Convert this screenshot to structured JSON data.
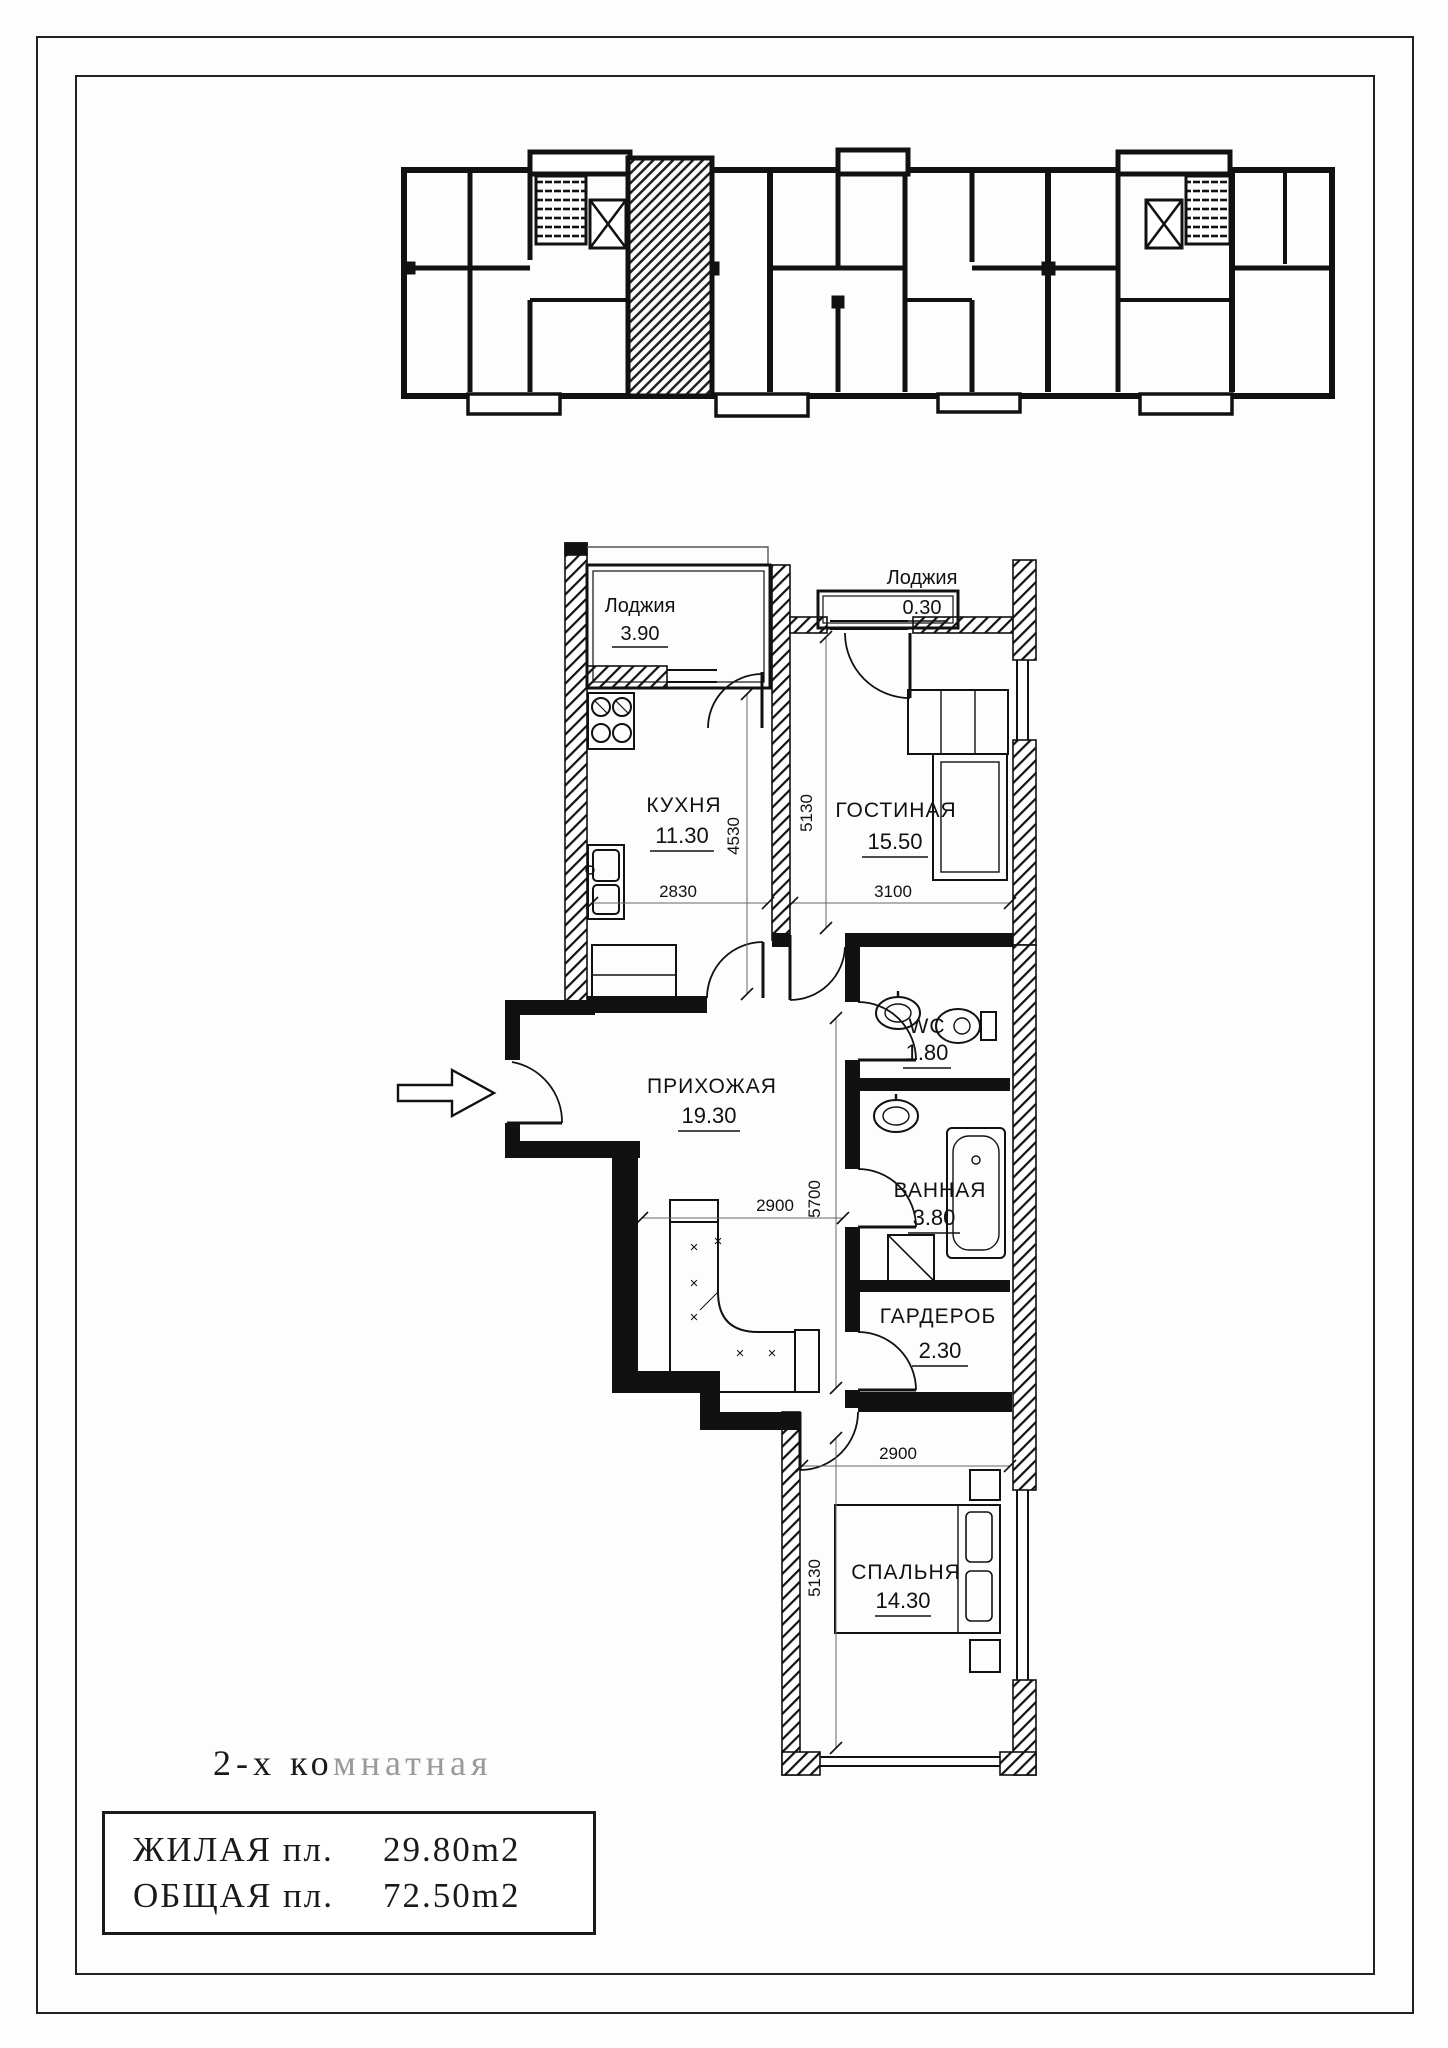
{
  "caption": {
    "black_part": "2-х ко",
    "gray_part": "мнатная",
    "full_text": "2-х комнатная"
  },
  "summary": {
    "rows": [
      {
        "label": "ЖИЛАЯ пл.",
        "value": "29.80m2"
      },
      {
        "label": "ОБЩАЯ пл.",
        "value": "72.50m2"
      }
    ]
  },
  "plan": {
    "rooms": {
      "loggia_top": {
        "name": "Лоджия",
        "area": "3.90"
      },
      "loggia_living": {
        "name": "Лоджия",
        "area": "0.30"
      },
      "kitchen": {
        "name": "КУХНЯ",
        "area": "11.30"
      },
      "living": {
        "name": "ГОСТИНАЯ",
        "area": "15.50"
      },
      "hall": {
        "name": "ПРИХОЖАЯ",
        "area": "19.30"
      },
      "wc": {
        "name": "WC",
        "area": "1.80"
      },
      "bath": {
        "name": "ВАННАЯ",
        "area": "3.80"
      },
      "wardrobe": {
        "name": "ГАРДЕРОБ",
        "area": "2.30"
      },
      "bedroom": {
        "name": "СПАЛЬНЯ",
        "area": "14.30"
      }
    },
    "dims": {
      "kitchen_w": "2830",
      "kitchen_h": "4530",
      "living_h": "5130",
      "living_w": "3100",
      "hall_w": "2900",
      "hall_h": "5700",
      "bedroom_w": "2900",
      "bedroom_h": "5130"
    }
  }
}
